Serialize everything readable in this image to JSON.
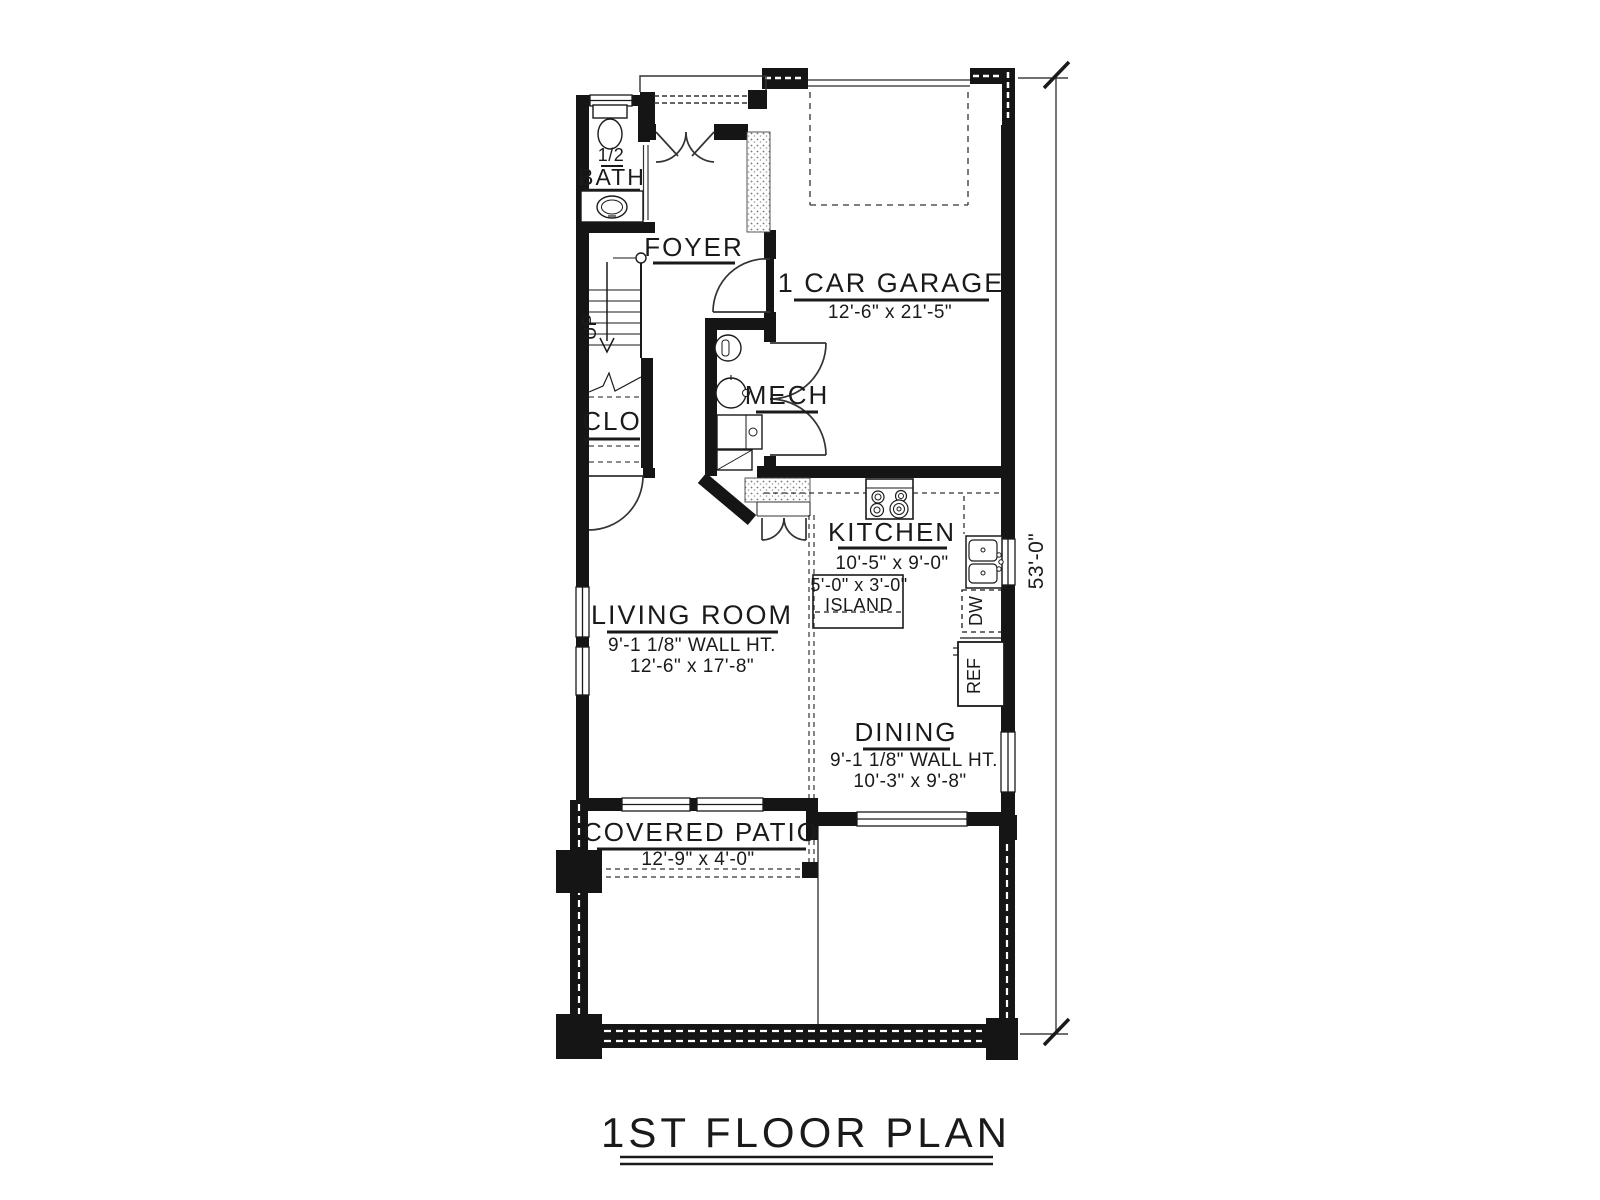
{
  "colors": {
    "ink": "#1a1a1a",
    "paper": "#ffffff"
  },
  "title": {
    "text": "1ST FLOOR PLAN"
  },
  "dimensions": {
    "overall_height": "53'-0\""
  },
  "rooms": {
    "bath": {
      "line1": "1/2",
      "line2": "BATH"
    },
    "foyer": {
      "label": "FOYER"
    },
    "garage": {
      "label": "1 CAR GARAGE",
      "dims": "12'-6\" x 21'-5\""
    },
    "stairs": {
      "direction": "UP"
    },
    "closet": {
      "label": "CLO"
    },
    "mech": {
      "label": "MECH"
    },
    "kitchen": {
      "label": "KITCHEN",
      "dims": "10'-5\" x 9'-0\""
    },
    "island": {
      "dims": "5'-0\" x 3'-0\"",
      "label": "ISLAND"
    },
    "living": {
      "label": "LIVING ROOM",
      "wall_height": "9'-1 1/8\" WALL HT.",
      "dims": "12'-6\" x 17'-8\""
    },
    "dining": {
      "label": "DINING",
      "wall_height": "9'-1 1/8\" WALL HT.",
      "dims": "10'-3\" x 9'-8\""
    },
    "patio": {
      "label": "COVERED PATIO",
      "dims": "12'-9\" x 4'-0\""
    }
  },
  "appliances": {
    "dishwasher": "DW",
    "refrigerator": "REF"
  }
}
